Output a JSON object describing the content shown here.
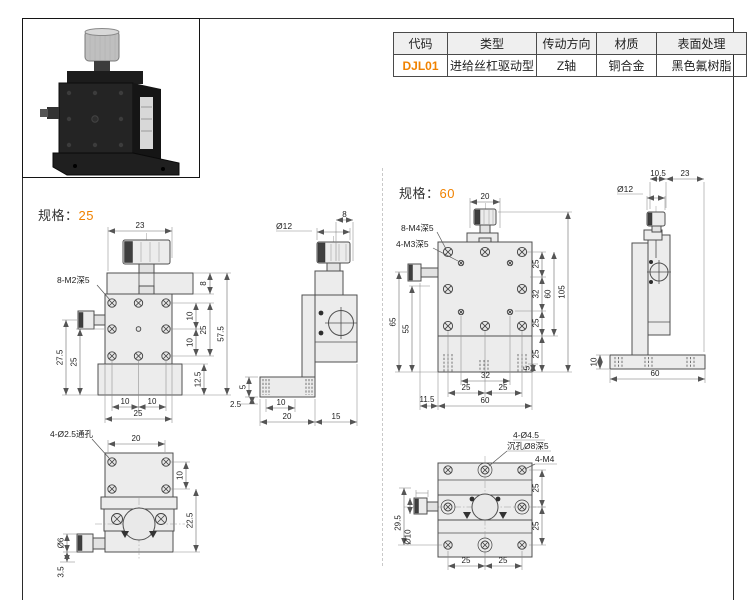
{
  "page": {
    "accent_color": "#f08200",
    "line_color": "#4f4f4f"
  },
  "spec_table": {
    "headers": [
      "代码",
      "类型",
      "传动方向",
      "材质",
      "表面处理"
    ],
    "row": {
      "code": "DJL01",
      "type": "进给丝杠驱动型",
      "direction": "Z轴",
      "material": "铜合金",
      "finish": "黑色氟树脂"
    }
  },
  "spec25": {
    "title_prefix": "规格：",
    "title_value": "25",
    "front": {
      "thread_label": "8-M2深5",
      "dim_top": "23",
      "dim_r1": "8",
      "dim_r2": "10",
      "dim_r3": "25",
      "dim_r4": "10",
      "dim_r5": "57.5",
      "dim_r6": "12.5",
      "dim_l1": "27.5",
      "dim_l2": "25",
      "dim_b1": "10",
      "dim_b2": "10",
      "dim_b3": "25"
    },
    "side": {
      "dim_dia": "Ø12",
      "dim_top": "8",
      "dim_l1": "5",
      "dim_l2": "2.5",
      "dim_b1": "10",
      "dim_b2": "20",
      "dim_b3": "15"
    },
    "bottom": {
      "hole_label": "4-Ø2.5通孔",
      "dim_top": "20",
      "dim_r1": "10",
      "dim_r2": "22.5",
      "dim_l1": "Ø6",
      "dim_l2": "3.5"
    }
  },
  "spec60": {
    "title_prefix": "规格：",
    "title_value": "60",
    "front": {
      "thread_label1": "8-M4深5",
      "thread_label2": "4-M3深5",
      "dim_top": "20",
      "dim_r1": "25",
      "dim_r2": "32",
      "dim_r3": "25",
      "dim_r4": "60",
      "dim_r5": "105",
      "dim_r6": "25",
      "dim_r7": "5",
      "dim_l1": "65",
      "dim_l2": "55",
      "dim_b1": "32",
      "dim_b2": "25",
      "dim_b3": "25",
      "dim_b4": "60",
      "dim_b5": "11.5"
    },
    "side": {
      "dim_t1": "10.5",
      "dim_t2": "23",
      "dim_dia": "Ø12",
      "dim_l1": "10",
      "dim_b1": "60"
    },
    "bottom": {
      "hole_label1": "4-Ø4.5",
      "hole_label2": "沉孔Ø8深5",
      "hole_label3": "4-M4",
      "dim_r1": "25",
      "dim_r2": "25",
      "dim_b1": "25",
      "dim_b2": "25",
      "dim_l1": "29.5",
      "dim_l2": "Ø10"
    }
  }
}
